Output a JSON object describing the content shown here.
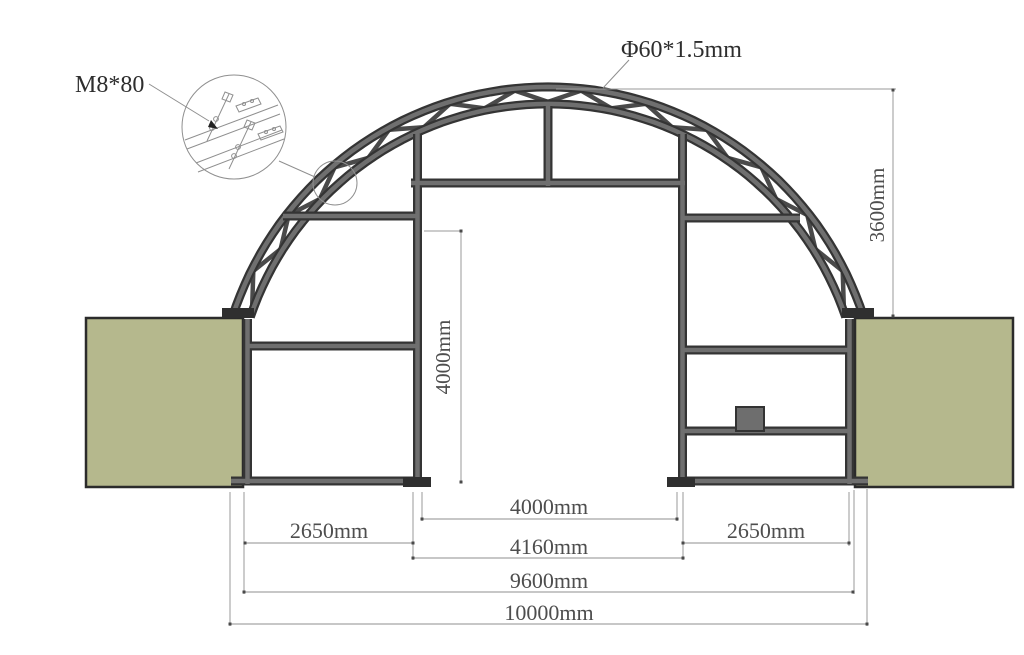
{
  "drawing": {
    "type": "engineering cross-section of arched container shelter",
    "background": "#ffffff"
  },
  "annotations": {
    "bolt_label": "M8*80",
    "tube_label": "Φ60*1.5mm"
  },
  "dimensions": {
    "arch_height": "3600mm",
    "door_height": "4000mm",
    "door_width": "4000mm",
    "door_frame_width": "4160mm",
    "left_bay_width": "2650mm",
    "right_bay_width": "2650mm",
    "inner_span": "9600mm",
    "total_span": "10000mm"
  },
  "colors": {
    "container_fill": "#b5b88d",
    "container_border": "#2b2b2b",
    "frame_dark": "#343434",
    "frame_grey": "#6f6f6f",
    "dim_line": "#949494",
    "text": "#4e4e4e"
  }
}
